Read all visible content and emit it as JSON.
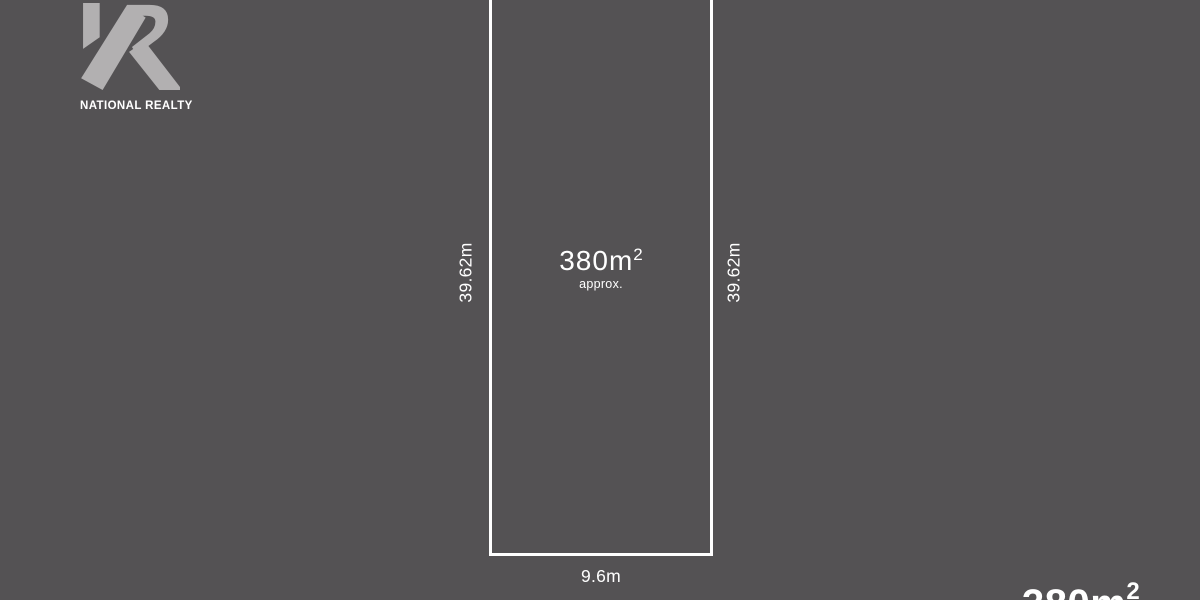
{
  "colors": {
    "background": "#545254",
    "lot_outline": "#ffffff",
    "logo_mark": "#b2b0b1",
    "text": "#ffffff"
  },
  "logo": {
    "brand": "NATIONAL REALTY",
    "mark_icon": "reversed-r-monogram"
  },
  "lot": {
    "area_value": "380m",
    "area_superscript": "2",
    "area_qualifier": "approx.",
    "frontage_label": "9.6m",
    "depth_left_label": "39.62m",
    "depth_right_label": "39.62m"
  },
  "watermark": {
    "area_value": "380m",
    "area_superscript": "2"
  }
}
